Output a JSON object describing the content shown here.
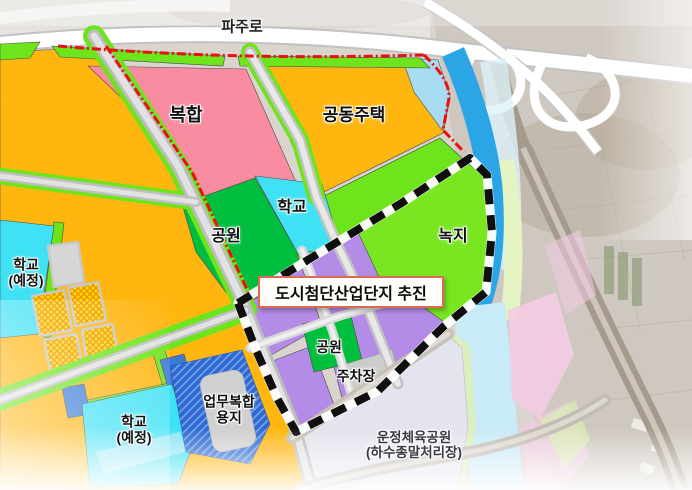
{
  "map_labels": {
    "road_top": "파주로",
    "callout": "도시첨단산업단지 추진",
    "mixed_use": "복합",
    "apartments": "공동주택",
    "school": "학교",
    "school_planned_line1": "학교",
    "school_planned_line2": "(예정)",
    "park_main": "공원",
    "green_space": "녹지",
    "park_small": "공원",
    "parking": "주차장",
    "business_line1": "업무복합",
    "business_line2": "용지",
    "sports_park_line1": "운정체육공원",
    "sports_park_line2": "(하수종말처리장)"
  },
  "colors": {
    "residential_orange": "#FFB60F",
    "mixed_pink": "#F98CA0",
    "school_cyan": "#3FE2F5",
    "park_green": "#00BE3E",
    "buffer_green": "#6EE41C",
    "greenspace_green": "#79E621",
    "industry_purple": "#B48CE8",
    "river_blue": "#2AA6E6",
    "business_blue": "#2F68D2",
    "parking_gray": "#CBCDCB",
    "sportspark_lavender": "#E4E4EF",
    "commercial_yellow": "#FFE000",
    "boundary_red": "#E81010",
    "boundary_black": "#0F0F0F",
    "callout_border": "#DC6A55"
  }
}
